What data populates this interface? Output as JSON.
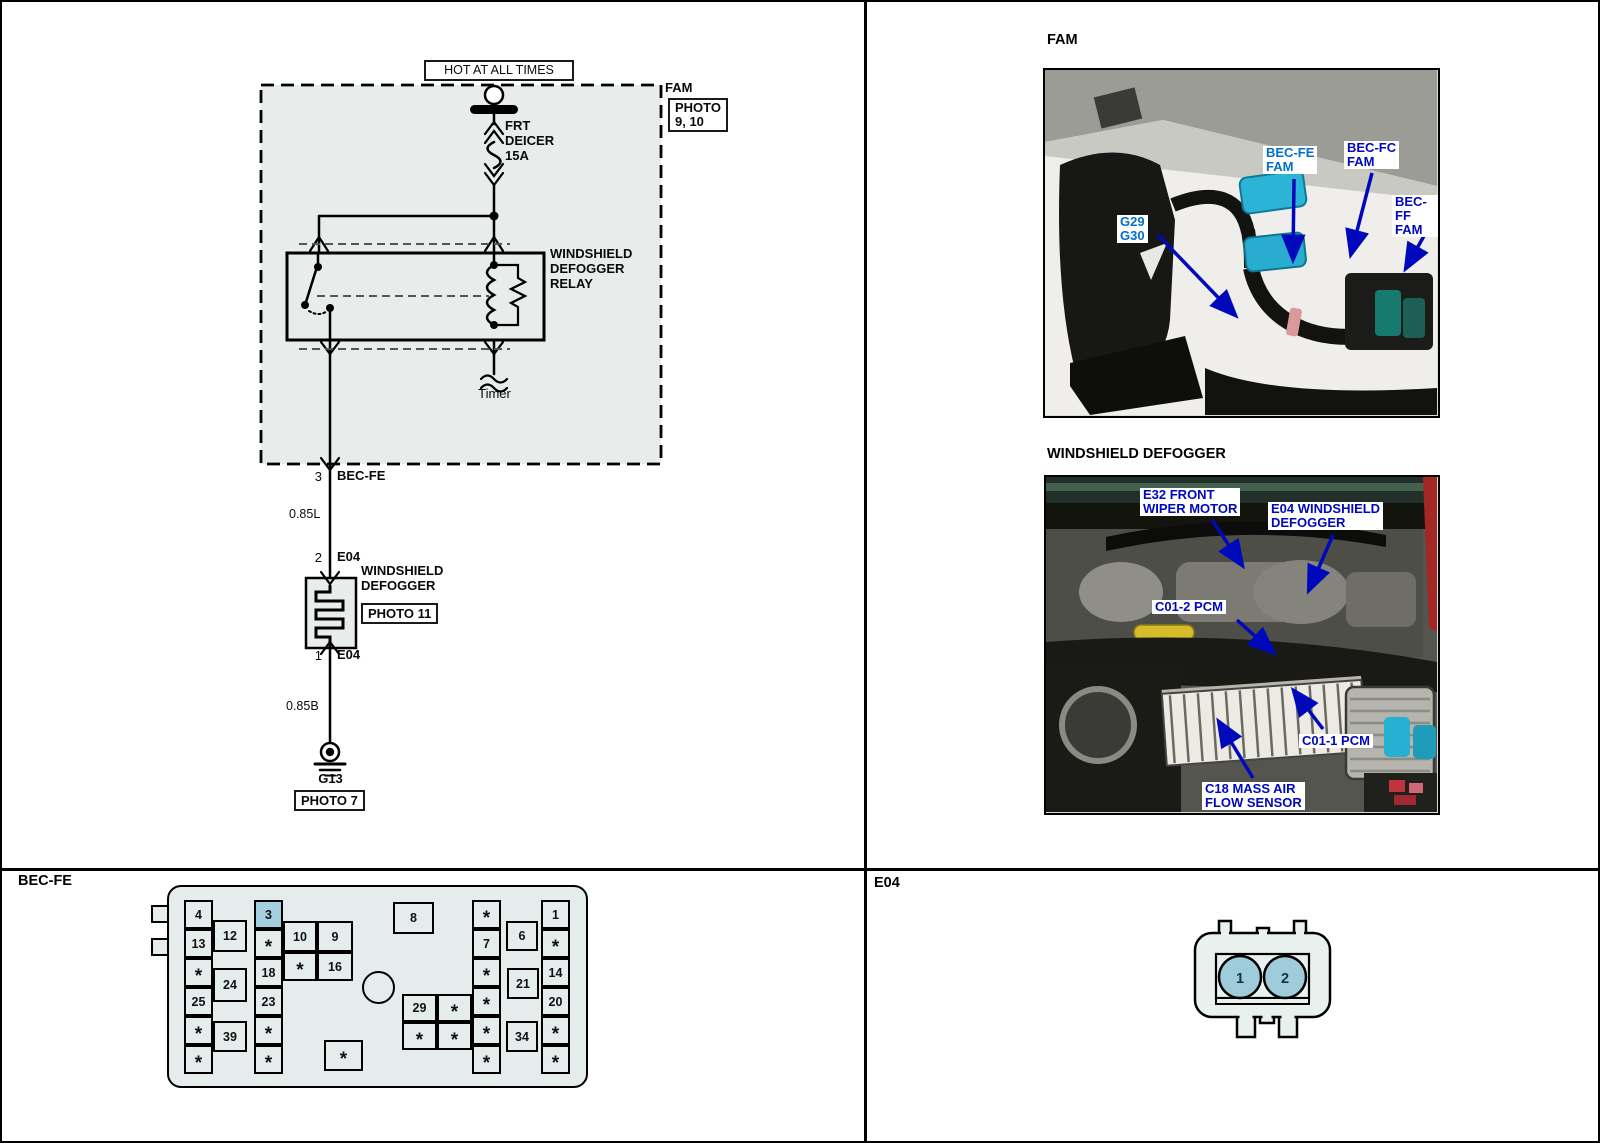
{
  "wiring": {
    "hot_at_all_times": "HOT AT ALL TIMES",
    "fam_ref": "FAM",
    "fam_photo_ref": "PHOTO\n9, 10",
    "fuse": "FRT\nDEICER\n15A",
    "relay": "WINDSHIELD\nDEFOGGER\nRELAY",
    "timer": "Timer",
    "pin_3": "3",
    "conn_bec_fe": "BEC-FE",
    "wire_085l": "0.85L",
    "pin_2": "2",
    "conn_e04_top": "E04",
    "defogger": "WINDSHIELD\nDEFOGGER",
    "defogger_photo_ref": "PHOTO 11",
    "pin_1": "1",
    "conn_e04_bottom": "E04",
    "wire_085b": "0.85B",
    "ground_g13": "G13",
    "ground_photo_ref": "PHOTO 7"
  },
  "fam_photo": {
    "title": "FAM",
    "labels": {
      "g29_g30": "G29\nG30",
      "bec_fe": "BEC-FE\nFAM",
      "bec_fc": "BEC-FC\nFAM",
      "bec_ff": "BEC-FF\nFAM"
    }
  },
  "defogger_photo": {
    "title": "WINDSHIELD DEFOGGER",
    "labels": {
      "e32": "E32 FRONT\nWIPER MOTOR",
      "e04": "E04 WINDSHIELD\nDEFOGGER",
      "c01_2": "C01-2 PCM",
      "c01_1": "C01-1 PCM",
      "c18": "C18 MASS AIR\nFLOW SENSOR"
    }
  },
  "bec_fe_panel": {
    "title": "BEC-FE",
    "highlighted_fuse": "3",
    "cells": [
      {
        "label": "4"
      },
      {
        "label": "13"
      },
      {
        "label": "*"
      },
      {
        "label": "25"
      },
      {
        "label": "*"
      },
      {
        "label": "*"
      },
      {
        "label": "12"
      },
      {
        "label": "24"
      },
      {
        "label": "39"
      },
      {
        "label": "3"
      },
      {
        "label": "*"
      },
      {
        "label": "18"
      },
      {
        "label": "23"
      },
      {
        "label": "*"
      },
      {
        "label": "*"
      },
      {
        "label": "10"
      },
      {
        "label": "9"
      },
      {
        "label": "*"
      },
      {
        "label": "16"
      },
      {
        "label": "8"
      },
      {
        "label": "*"
      },
      {
        "label": "29"
      },
      {
        "label": "*"
      },
      {
        "label": "*"
      },
      {
        "label": "*"
      },
      {
        "label": "*"
      },
      {
        "label": "7"
      },
      {
        "label": "*"
      },
      {
        "label": "*"
      },
      {
        "label": "*"
      },
      {
        "label": "*"
      },
      {
        "label": "6"
      },
      {
        "label": "21"
      },
      {
        "label": "34"
      },
      {
        "label": "1"
      },
      {
        "label": "*"
      },
      {
        "label": "14"
      },
      {
        "label": "20"
      },
      {
        "label": "*"
      },
      {
        "label": "*"
      }
    ]
  },
  "e04_panel": {
    "title": "E04",
    "pins": [
      "1",
      "2"
    ]
  },
  "colors": {
    "highlight_blue": "#a3cfe0",
    "label_blue": "#0008bb",
    "label_light_blue": "#0070cc",
    "panel_fill": "#e4edec",
    "pin_blue": "#9fccdb"
  }
}
